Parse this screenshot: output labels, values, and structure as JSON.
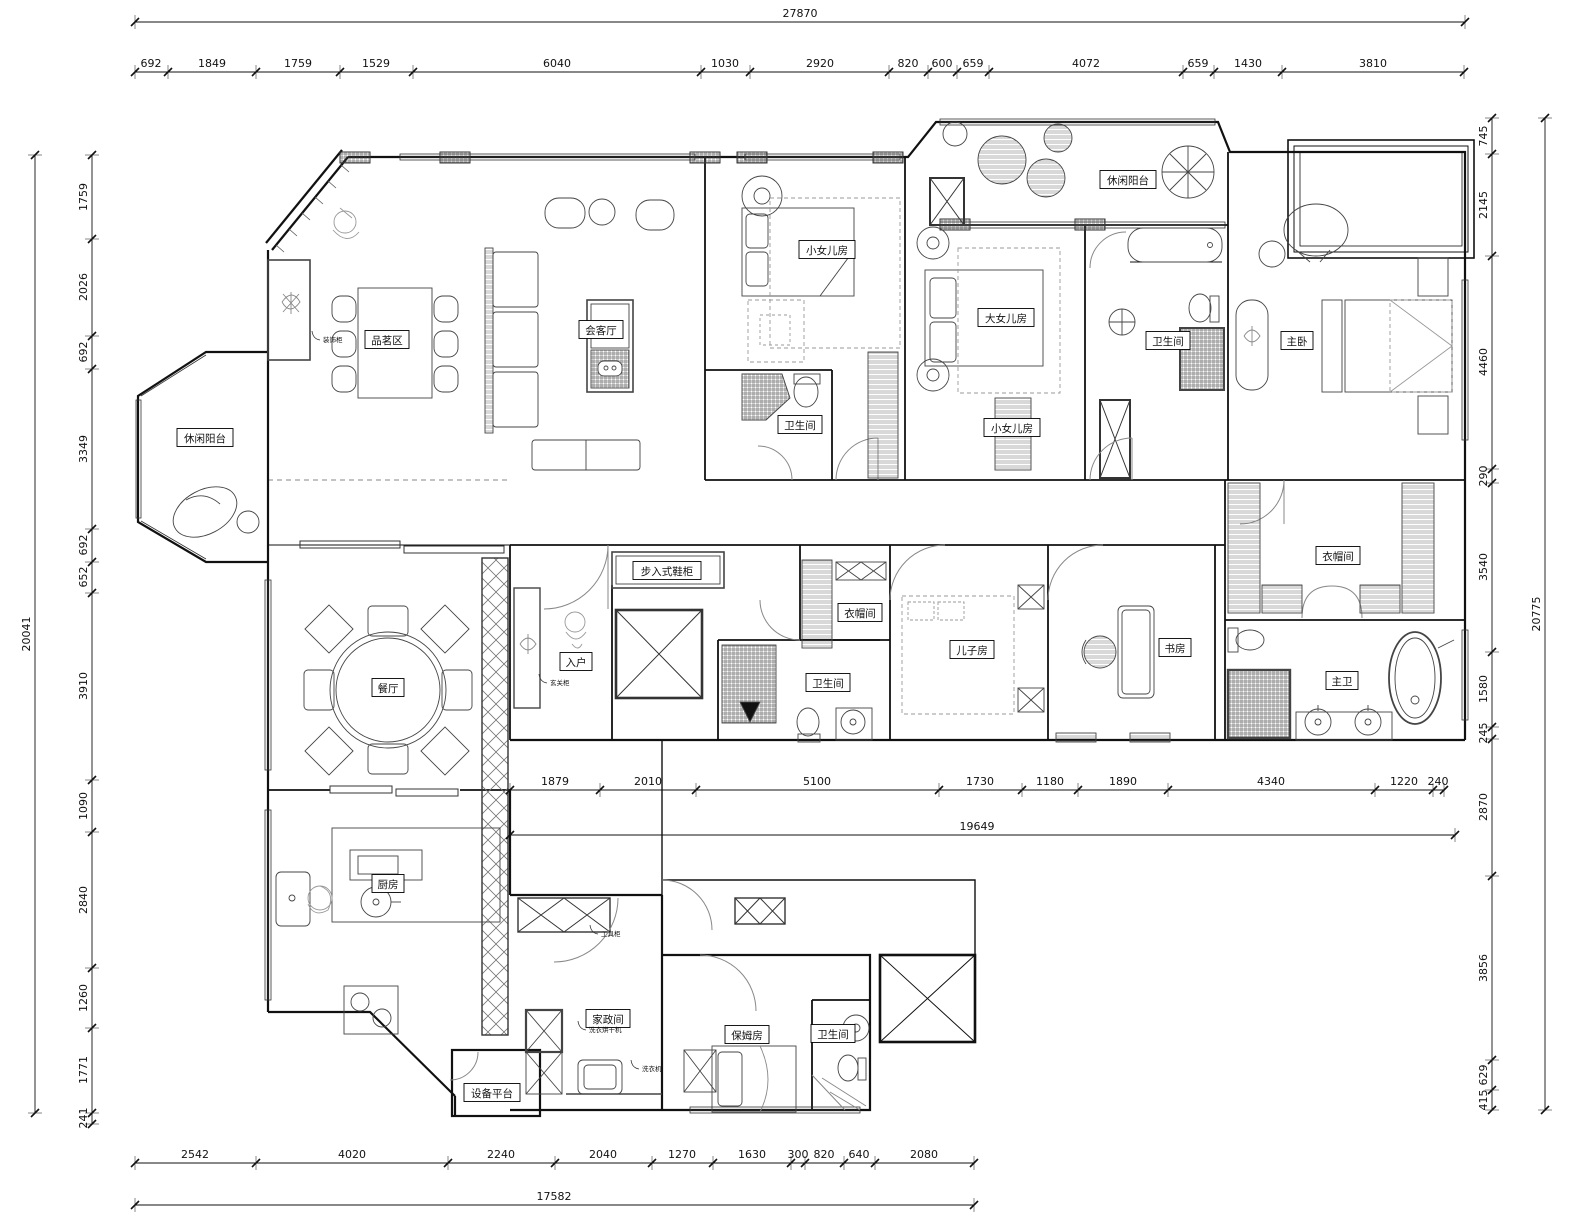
{
  "meta": {
    "type": "residential-floor-plan",
    "units": "mm"
  },
  "colors": {
    "wall": "#111111",
    "furniture": "#555555",
    "hatch": "#777777",
    "dim": "#111111",
    "bg": "#ffffff"
  },
  "rooms": [
    {
      "label": "休闲阳台",
      "x": 205,
      "y": 438
    },
    {
      "label": "品茗区",
      "x": 387,
      "y": 340
    },
    {
      "label": "会客厅",
      "x": 601,
      "y": 330
    },
    {
      "label": "小女儿房",
      "x": 827,
      "y": 250
    },
    {
      "label": "大女儿房",
      "x": 1006,
      "y": 318
    },
    {
      "label": "休闲阳台",
      "x": 1128,
      "y": 180
    },
    {
      "label": "主卧",
      "x": 1297,
      "y": 341
    },
    {
      "label": "卫生间",
      "x": 1168,
      "y": 341
    },
    {
      "label": "小女儿房",
      "x": 1012,
      "y": 428
    },
    {
      "label": "卫生间",
      "x": 800,
      "y": 425
    },
    {
      "label": "步入式鞋柜",
      "x": 667,
      "y": 571
    },
    {
      "label": "入户",
      "x": 576,
      "y": 662
    },
    {
      "label": "衣帽间",
      "x": 860,
      "y": 613
    },
    {
      "label": "卫生间",
      "x": 828,
      "y": 683
    },
    {
      "label": "儿子房",
      "x": 972,
      "y": 650
    },
    {
      "label": "书房",
      "x": 1175,
      "y": 648
    },
    {
      "label": "衣帽间",
      "x": 1338,
      "y": 556
    },
    {
      "label": "主卫",
      "x": 1342,
      "y": 681
    },
    {
      "label": "餐厅",
      "x": 388,
      "y": 688
    },
    {
      "label": "厨房",
      "x": 388,
      "y": 884
    },
    {
      "label": "家政间",
      "x": 608,
      "y": 1019
    },
    {
      "label": "保姆房",
      "x": 747,
      "y": 1035
    },
    {
      "label": "卫生间",
      "x": 833,
      "y": 1034
    },
    {
      "label": "设备平台",
      "x": 492,
      "y": 1093
    }
  ],
  "annotations": [
    {
      "label": "装饰柜",
      "x": 326,
      "y": 342
    },
    {
      "label": "玄关柜",
      "x": 553,
      "y": 685
    },
    {
      "label": "工具柜",
      "x": 604,
      "y": 936
    },
    {
      "label": "洗衣烘干机",
      "x": 592,
      "y": 1032
    },
    {
      "label": "洗衣机",
      "x": 645,
      "y": 1071
    }
  ],
  "dim_rows": [
    {
      "id": "top-overall",
      "dir": "h",
      "pos": 22,
      "from": 135,
      "to": 1465,
      "ticks": [
        135,
        1465
      ],
      "labels": [
        {
          "t": "27870",
          "at": 800
        }
      ]
    },
    {
      "id": "top-segments",
      "dir": "h",
      "pos": 72,
      "from": 135,
      "to": 1464,
      "ticks": [
        135,
        168,
        256,
        340,
        413,
        701,
        750,
        889,
        928,
        957,
        989,
        1183,
        1214,
        1282,
        1464
      ],
      "labels": [
        {
          "t": "692",
          "at": 151
        },
        {
          "t": "1849",
          "at": 212
        },
        {
          "t": "1759",
          "at": 298
        },
        {
          "t": "1529",
          "at": 376
        },
        {
          "t": "6040",
          "at": 557
        },
        {
          "t": "1030",
          "at": 725
        },
        {
          "t": "2920",
          "at": 820
        },
        {
          "t": "820",
          "at": 908
        },
        {
          "t": "600",
          "at": 942
        },
        {
          "t": "659",
          "at": 973
        },
        {
          "t": "4072",
          "at": 1086
        },
        {
          "t": "659",
          "at": 1198
        },
        {
          "t": "1430",
          "at": 1248
        },
        {
          "t": "3810",
          "at": 1373
        }
      ]
    },
    {
      "id": "left-overall",
      "dir": "v",
      "pos": 35,
      "from": 155,
      "to": 1113,
      "ticks": [
        155,
        1113
      ],
      "labels": [
        {
          "t": "20041",
          "at": 634
        }
      ]
    },
    {
      "id": "left-segments",
      "dir": "v",
      "pos": 92,
      "from": 155,
      "to": 1124,
      "ticks": [
        155,
        239,
        336,
        369,
        529,
        562,
        593,
        780,
        832,
        968,
        1028,
        1113,
        1124
      ],
      "labels": [
        {
          "t": "1759",
          "at": 197
        },
        {
          "t": "2026",
          "at": 287
        },
        {
          "t": "692",
          "at": 352
        },
        {
          "t": "3349",
          "at": 449
        },
        {
          "t": "692",
          "at": 545
        },
        {
          "t": "652",
          "at": 577
        },
        {
          "t": "3910",
          "at": 686
        },
        {
          "t": "1090",
          "at": 806
        },
        {
          "t": "2840",
          "at": 900
        },
        {
          "t": "1260",
          "at": 998
        },
        {
          "t": "1771",
          "at": 1070
        },
        {
          "t": "241",
          "at": 1118
        }
      ]
    },
    {
      "id": "right-segments",
      "dir": "v",
      "pos": 1492,
      "from": 118,
      "to": 1110,
      "ticks": [
        118,
        154,
        256,
        469,
        483,
        652,
        727,
        739,
        876,
        1060,
        1090,
        1110
      ],
      "labels": [
        {
          "t": "745",
          "at": 136
        },
        {
          "t": "2145",
          "at": 205
        },
        {
          "t": "4460",
          "at": 362
        },
        {
          "t": "290",
          "at": 476
        },
        {
          "t": "3540",
          "at": 567
        },
        {
          "t": "1580",
          "at": 689
        },
        {
          "t": "245",
          "at": 733
        },
        {
          "t": "2870",
          "at": 807
        },
        {
          "t": "3856",
          "at": 968
        },
        {
          "t": "629",
          "at": 1075
        },
        {
          "t": "415",
          "at": 1100
        }
      ]
    },
    {
      "id": "right-overall",
      "dir": "v",
      "pos": 1545,
      "from": 118,
      "to": 1110,
      "ticks": [
        118,
        1110
      ],
      "labels": [
        {
          "t": "20775",
          "at": 614
        }
      ]
    },
    {
      "id": "middle-segments",
      "dir": "h",
      "pos": 790,
      "from": 510,
      "to": 1444,
      "ticks": [
        510,
        600,
        696,
        939,
        1022,
        1078,
        1168,
        1375,
        1433,
        1444
      ],
      "labels": [
        {
          "t": "1879",
          "at": 555
        },
        {
          "t": "2010",
          "at": 648
        },
        {
          "t": "5100",
          "at": 817
        },
        {
          "t": "1730",
          "at": 980
        },
        {
          "t": "1180",
          "at": 1050
        },
        {
          "t": "1890",
          "at": 1123
        },
        {
          "t": "4340",
          "at": 1271
        },
        {
          "t": "1220",
          "at": 1404
        },
        {
          "t": "240",
          "at": 1438
        }
      ]
    },
    {
      "id": "middle-overall",
      "dir": "h",
      "pos": 835,
      "from": 510,
      "to": 1455,
      "ticks": [
        510,
        1455
      ],
      "labels": [
        {
          "t": "19649",
          "at": 977
        }
      ]
    },
    {
      "id": "bottom-segments",
      "dir": "h",
      "pos": 1163,
      "from": 135,
      "to": 974,
      "ticks": [
        135,
        256,
        448,
        555,
        652,
        713,
        791,
        805,
        844,
        875,
        974
      ],
      "labels": [
        {
          "t": "2542",
          "at": 195
        },
        {
          "t": "4020",
          "at": 352
        },
        {
          "t": "2240",
          "at": 501
        },
        {
          "t": "2040",
          "at": 603
        },
        {
          "t": "1270",
          "at": 682
        },
        {
          "t": "1630",
          "at": 752
        },
        {
          "t": "300",
          "at": 798
        },
        {
          "t": "820",
          "at": 824
        },
        {
          "t": "640",
          "at": 859
        },
        {
          "t": "2080",
          "at": 924
        }
      ]
    },
    {
      "id": "bottom-overall",
      "dir": "h",
      "pos": 1205,
      "from": 135,
      "to": 974,
      "ticks": [
        135,
        974
      ],
      "labels": [
        {
          "t": "17582",
          "at": 554
        }
      ]
    }
  ]
}
